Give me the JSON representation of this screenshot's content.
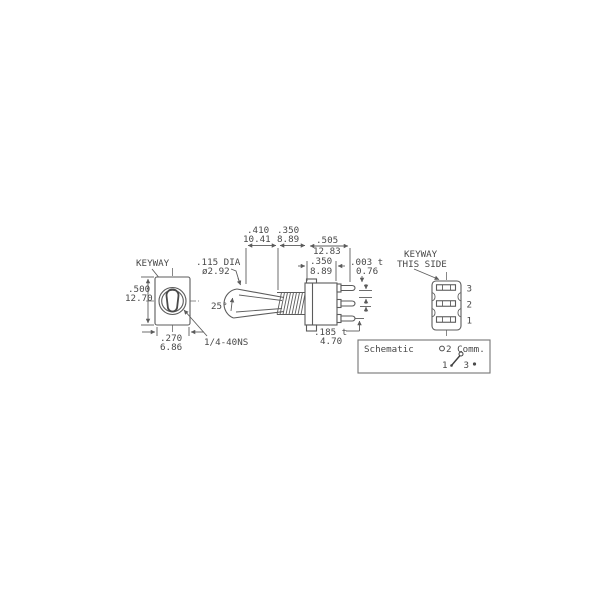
{
  "colors": {
    "background": "#ffffff",
    "line": "#5b5b5b",
    "text": "#484848"
  },
  "front_view": {
    "keyway_label": "KEYWAY",
    "height_in": ".500",
    "height_mm": "12.70",
    "width_in": ".270",
    "width_mm": "6.86",
    "thread_spec": "1/4-40NS"
  },
  "actuator": {
    "tip_dia_in": ".115 DIA",
    "tip_dia_mm": "ø2.92",
    "throw_angle": "25°"
  },
  "dimensions": {
    "d410_in": ".410",
    "d410_mm": "10.41",
    "d350a_in": ".350",
    "d350a_mm": "8.89",
    "d505_in": ".505",
    "d505_mm": "12.83",
    "d350b_in": ".350",
    "d350b_mm": "8.89",
    "d003_in": ".003 t",
    "d003_mm": "0.76",
    "d185_in": ".185 t",
    "d185_mm": "4.70"
  },
  "rear_view": {
    "keyway_note_line1": "KEYWAY",
    "keyway_note_line2": "THIS SIDE",
    "pin_3": "3",
    "pin_2": "2",
    "pin_1": "1"
  },
  "schematic": {
    "title": "Schematic",
    "common_symbol_label": "2 Comm.",
    "terminal_left": "1",
    "terminal_right": "3"
  }
}
